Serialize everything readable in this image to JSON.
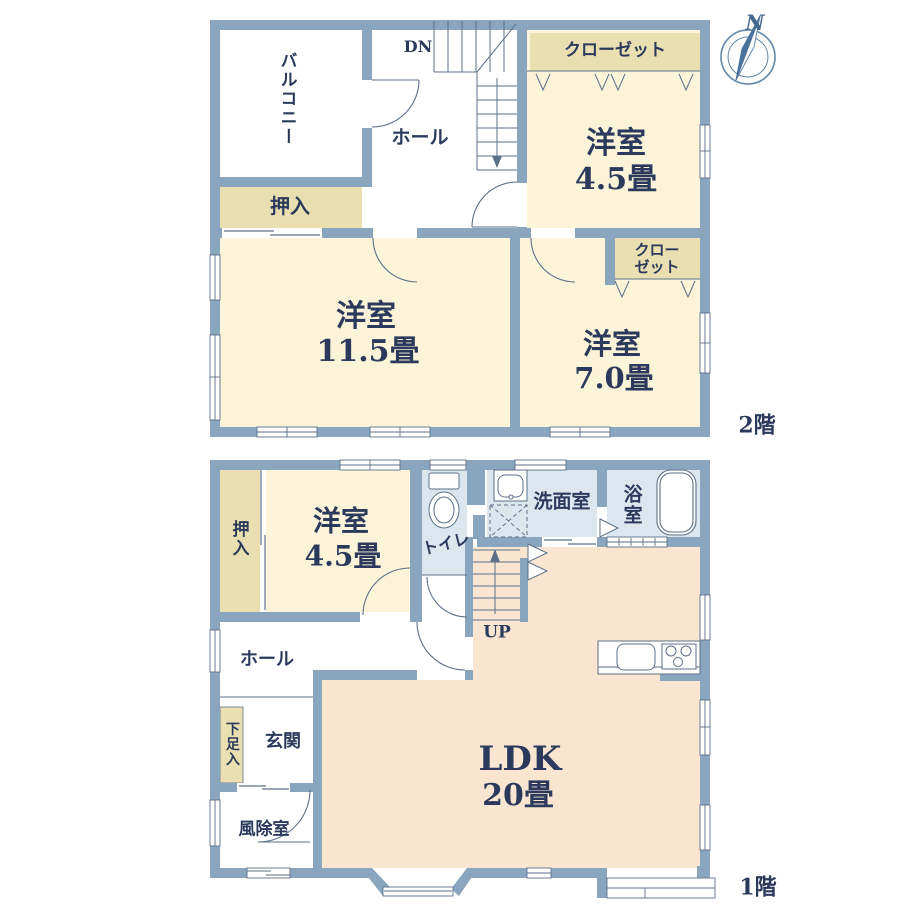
{
  "colors": {
    "wall": "#8aa5be",
    "line": "#5c708a",
    "room_cream": "#fcf4d8",
    "closet_beige": "#e9dfb0",
    "water_blue": "#dce6ef",
    "ldk_peach": "#fae6d0",
    "text_navy": "#2b3a5c",
    "compass_blue": "#4a739c"
  },
  "compass": {
    "north": "N"
  },
  "floor2": {
    "floor_label": "2階",
    "balcony": "バルコニー",
    "hall": "ホール",
    "stairs_label": "DN",
    "closet": "クローゼット",
    "closet_small": {
      "line1": "クロー",
      "line2": "ゼット"
    },
    "oshiire": "押入",
    "room_45": {
      "name": "洋室",
      "size": "4.5畳"
    },
    "room_115": {
      "name": "洋室",
      "size": "11.5畳"
    },
    "room_70": {
      "name": "洋室",
      "size": "7.0畳"
    }
  },
  "floor1": {
    "floor_label": "1階",
    "oshiire": "押入",
    "room_45": {
      "name": "洋室",
      "size": "4.5畳"
    },
    "toilet": "トイレ",
    "washroom": "洗面室",
    "bathroom": "浴室",
    "stairs_label": "UP",
    "hall": "ホール",
    "entrance": "玄関",
    "shoe_cabinet": "下足入",
    "windbreak_room": "風除室",
    "ldk": {
      "name": "LDK",
      "size": "20畳"
    }
  }
}
